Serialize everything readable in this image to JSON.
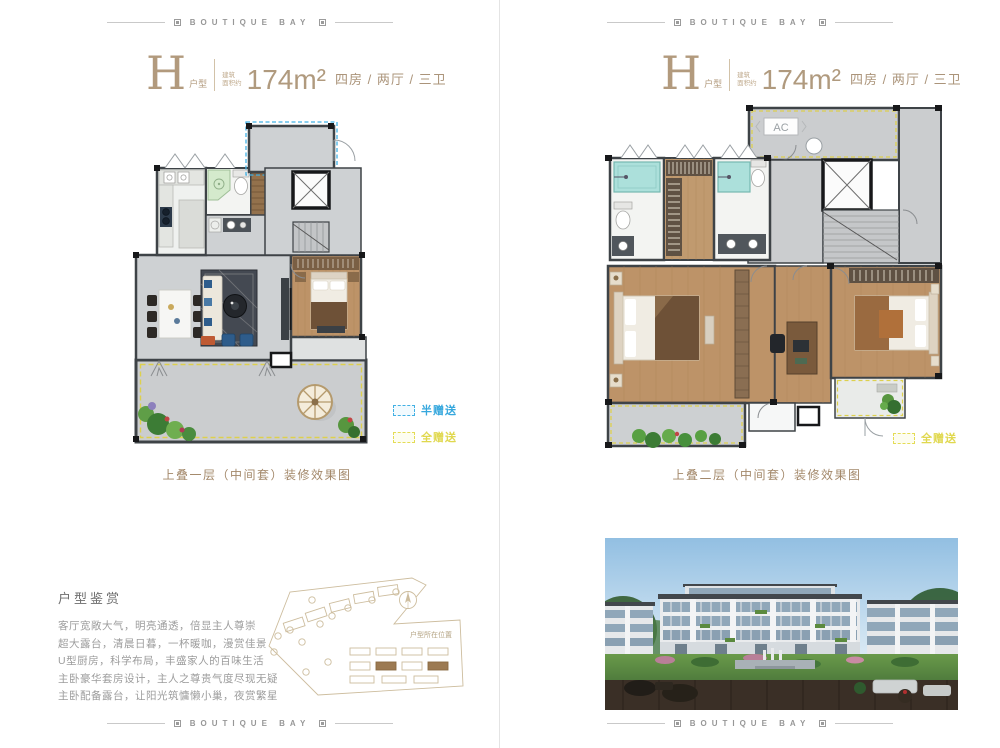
{
  "brand": {
    "name": "BOUTIQUE BAY"
  },
  "colors": {
    "accent_tan": "#b29a7d",
    "legend_blue": "#35a7dd",
    "legend_yellow": "#e0d84e",
    "wall": "#3e4347",
    "wood_floor": "#bd9368",
    "tile_floor": "#ced1d3"
  },
  "pages": [
    {
      "title": {
        "letter": "H",
        "type_label": "户型",
        "area_line1": "建筑",
        "area_line2": "面积约",
        "area": "174m²",
        "rooms": "四房 / 两厅 / 三卫"
      },
      "caption": "上叠一层（中间套）装修效果图",
      "legend": [
        {
          "label": "半赠送",
          "color": "#35a7dd"
        },
        {
          "label": "全赠送",
          "color": "#e0d84e"
        }
      ]
    },
    {
      "title": {
        "letter": "H",
        "type_label": "户型",
        "area_line1": "建筑",
        "area_line2": "面积约",
        "area": "174m²",
        "rooms": "四房 / 两厅 / 三卫"
      },
      "caption": "上叠二层（中间套）装修效果图",
      "legend": [
        {
          "label": "全赠送",
          "color": "#e0d84e"
        }
      ],
      "plan": {
        "ac_label": "AC"
      }
    }
  ],
  "appreciation": {
    "heading": "户型鉴赏",
    "lines": [
      "客厅宽敞大气，明亮通透，倍显主人尊崇",
      "超大露台，清晨日暮，一杯暖咖，漫赏佳景",
      "U型厨房，科学布局，丰盛家人的百味生活",
      "主卧豪华套房设计，主人之尊贵气度尽现无疑",
      "主卧配备露台，让阳光筑慵懒小巢，夜赏繁星"
    ]
  },
  "siteplan": {
    "label": "户型所在位置"
  }
}
